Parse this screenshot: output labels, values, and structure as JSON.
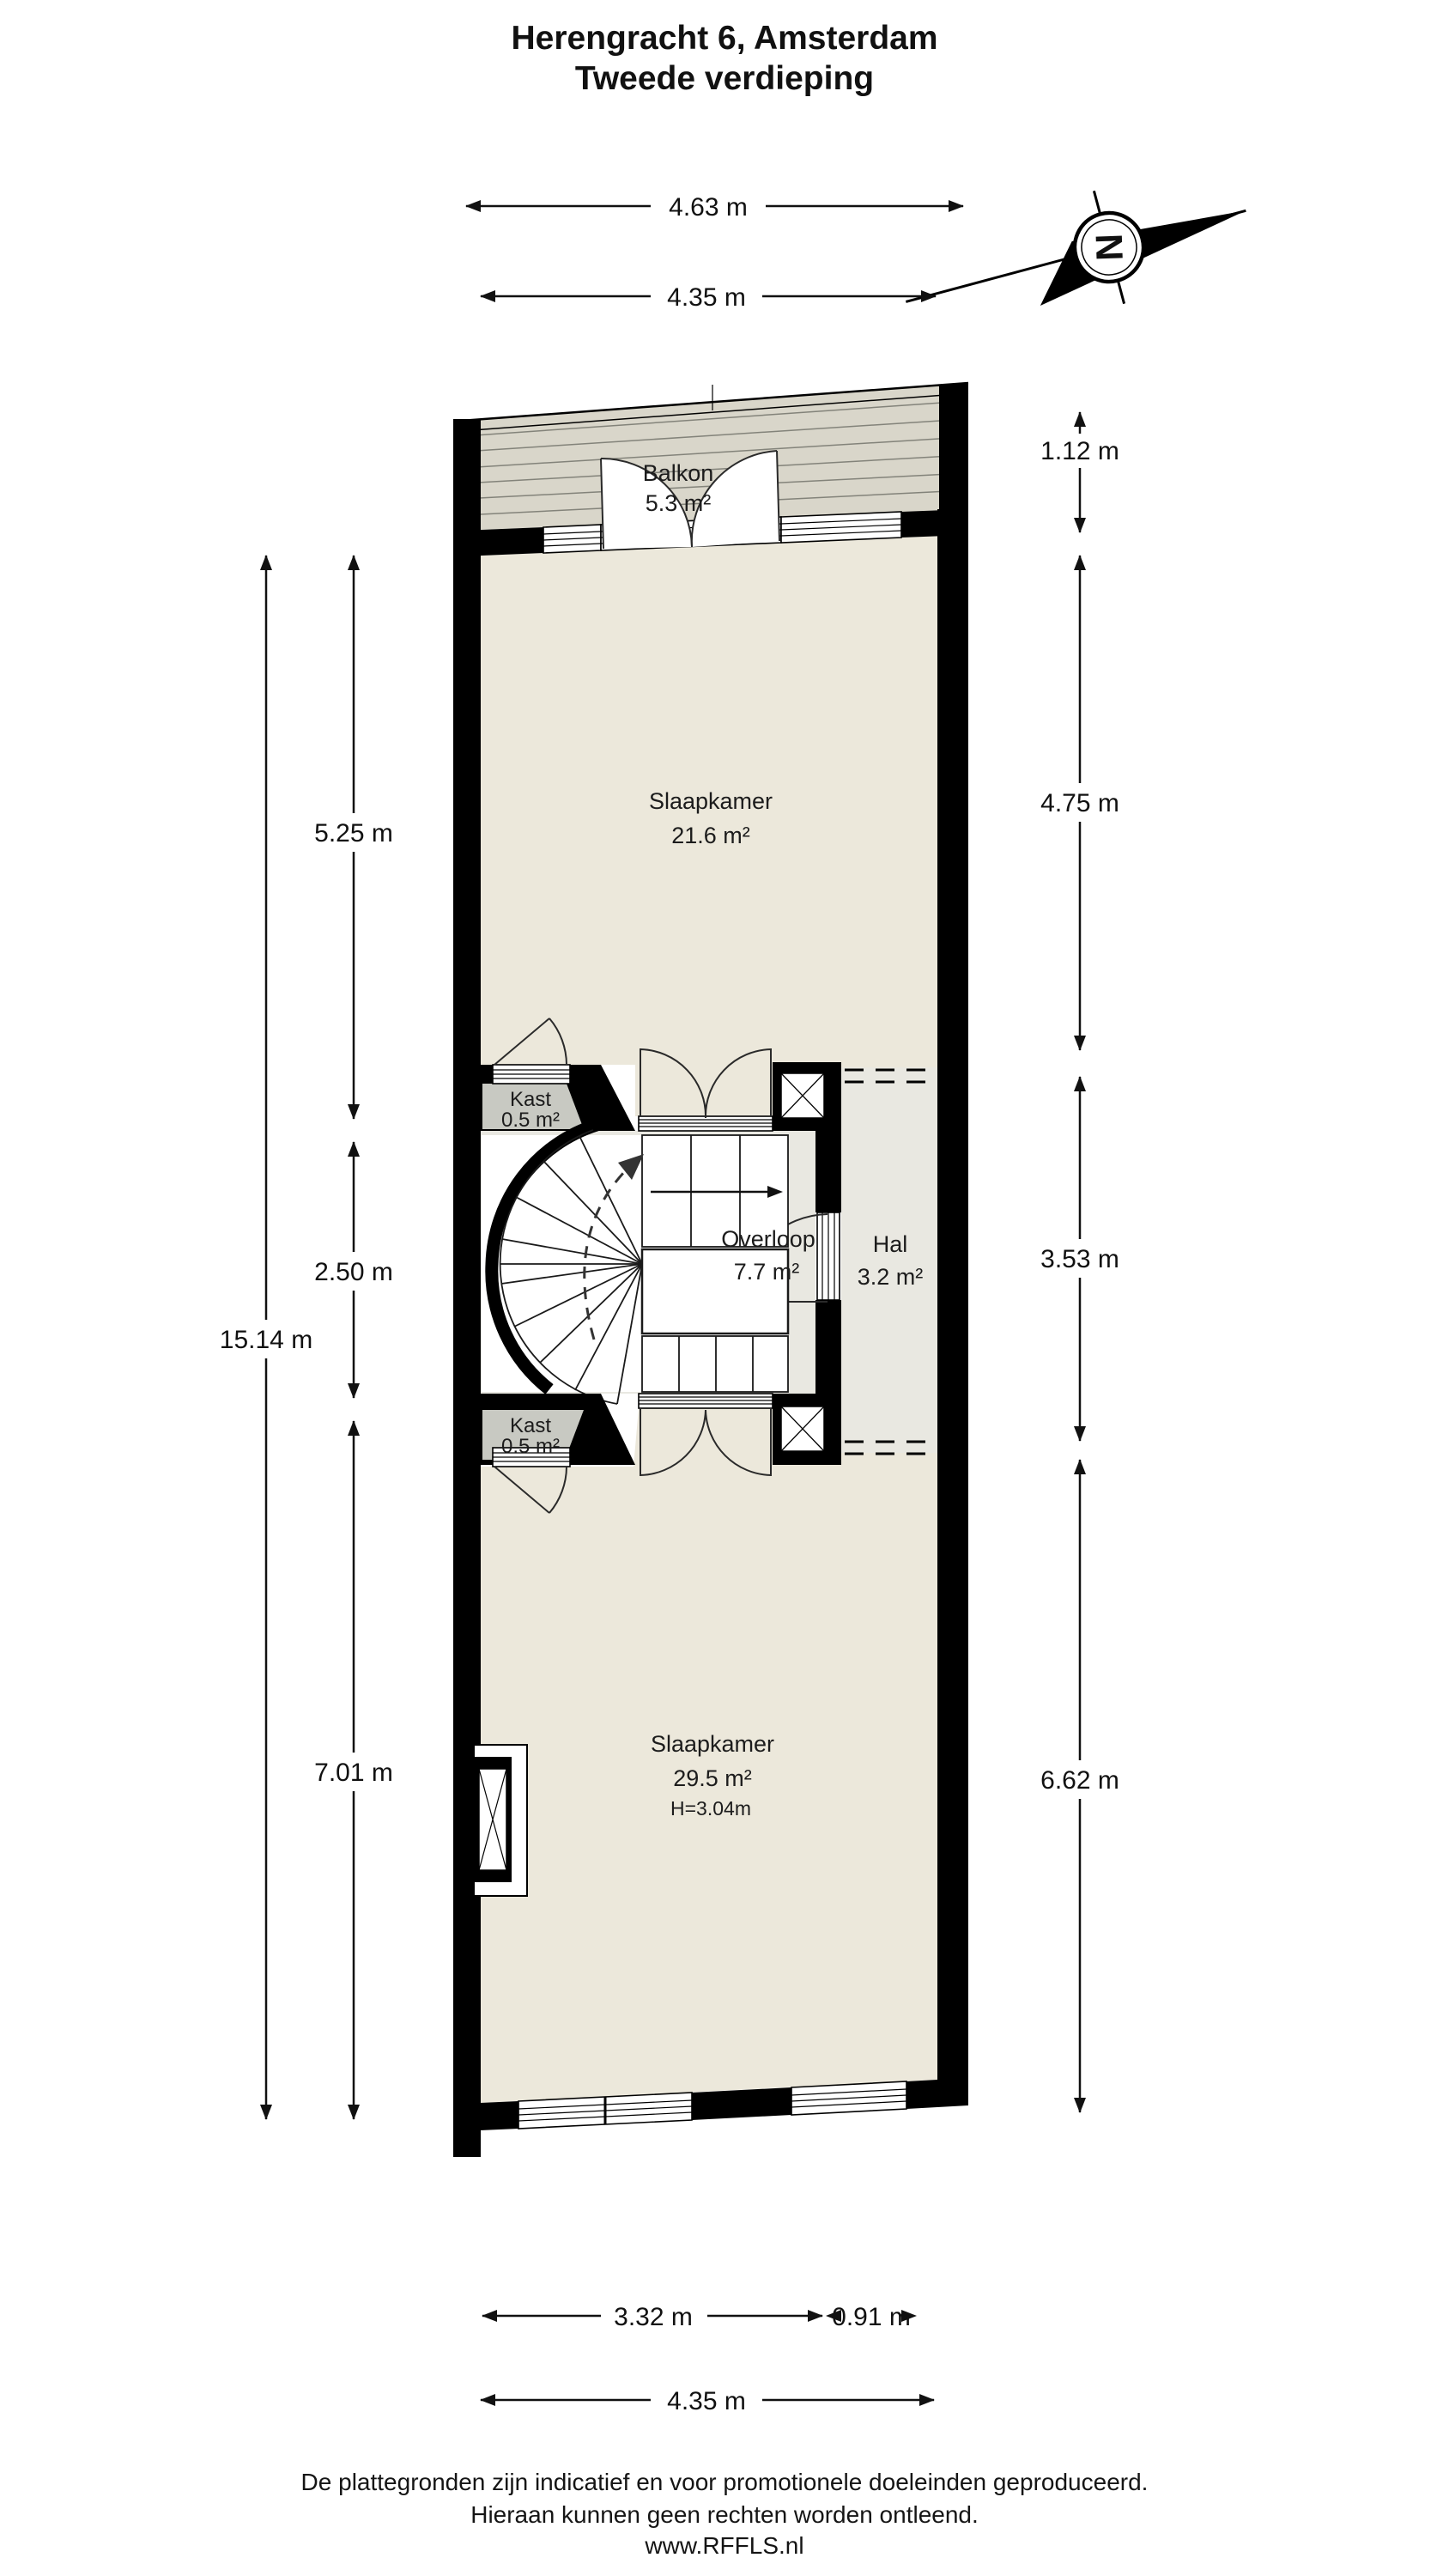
{
  "title": {
    "line1": "Herengracht 6, Amsterdam",
    "line2": "Tweede verdieping"
  },
  "compass": {
    "north_label": "N"
  },
  "rooms": {
    "balkon": {
      "name": "Balkon",
      "area": "5.3 m²"
    },
    "slaapkamer1": {
      "name": "Slaapkamer",
      "area": "21.6 m²"
    },
    "kast1": {
      "name": "Kast",
      "area": "0.5 m²"
    },
    "overloop": {
      "name": "Overloop",
      "area": "7.7 m²"
    },
    "hal": {
      "name": "Hal",
      "area": "3.2 m²"
    },
    "kast2": {
      "name": "Kast",
      "area": "0.5 m²"
    },
    "slaapkamer2": {
      "name": "Slaapkamer",
      "area": "29.5 m²",
      "ceiling_height": "H=3.04m"
    }
  },
  "dimensions": {
    "top_outer": "4.63 m",
    "top_inner": "4.35 m",
    "right_balcony": "1.12 m",
    "right_upper": "4.75 m",
    "right_middle": "3.53 m",
    "right_lower": "6.62 m",
    "left_upper": "5.25 m",
    "left_middle": "2.50 m",
    "left_lower": "7.01 m",
    "left_total": "15.14 m",
    "bottom_main": "3.32 m",
    "bottom_small": "0.91 m",
    "bottom_total": "4.35 m"
  },
  "footer": {
    "line1": "De plattegronden zijn indicatief en voor promotionele doeleinden geproduceerd.",
    "line2": "Hieraan kunnen geen rechten worden ontleend.",
    "line3": "www.RFFLS.nl"
  },
  "colors": {
    "wall": "#000000",
    "floor": "#ece8db",
    "deck": "#d9d6ca",
    "hallway": "#e9e8e1",
    "closet": "#c8c9c2"
  }
}
